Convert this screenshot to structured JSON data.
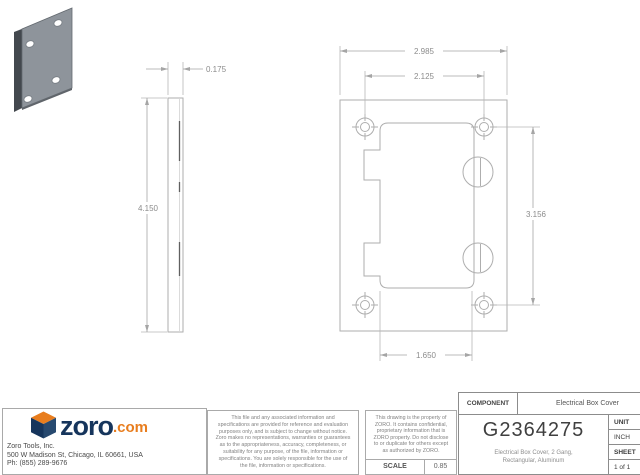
{
  "drawing": {
    "dims": {
      "overall_width": "2.985",
      "hole_spacing_h": "2.125",
      "hole_spacing_v": "3.156",
      "opening_to_screw": "1.650",
      "thickness": "0.175",
      "overall_height": "4.150"
    }
  },
  "title_block": {
    "component_label": "COMPONENT",
    "component_value": "Electrical Box Cover",
    "part_number": "G2364275",
    "description": "Electrical Box Cover, 2 Gang, Rectangular, Aluminum",
    "unit_label": "UNIT",
    "unit_value": "INCH",
    "sheet_label": "SHEET",
    "sheet_value": "1 of 1",
    "scale_label": "SCALE",
    "scale_value": "0.85",
    "disclaimer1": "This file and any associated information and specifications are provided for reference and evaluation purposes only, and is subject to change without notice. Zoro makes no representations, warranties or guarantees as to the appropriateness, accuracy, completeness, or suitability for any purpose, of the file, information or specifications. You are solely responsible for the use of the file, information or specifications.",
    "disclaimer2": "This drawing is the property of ZORO. It contains confidential, proprietary information that is ZORO property. Do not disclose to or duplicate for others except as authorized by ZORO."
  },
  "company": {
    "logo_text": "zoro",
    "logo_suffix": ".com",
    "name": "Zoro Tools, Inc.",
    "address": "500 W Madison St, Chicago, IL 60661, USA",
    "phone": "Ph: (855) 289-9676"
  },
  "colors": {
    "navy": "#16355c",
    "navy_light": "#27496f",
    "orange": "#e87d1e",
    "line_gray": "#aeaeae",
    "dim_text_gray": "#8c8c8c"
  }
}
